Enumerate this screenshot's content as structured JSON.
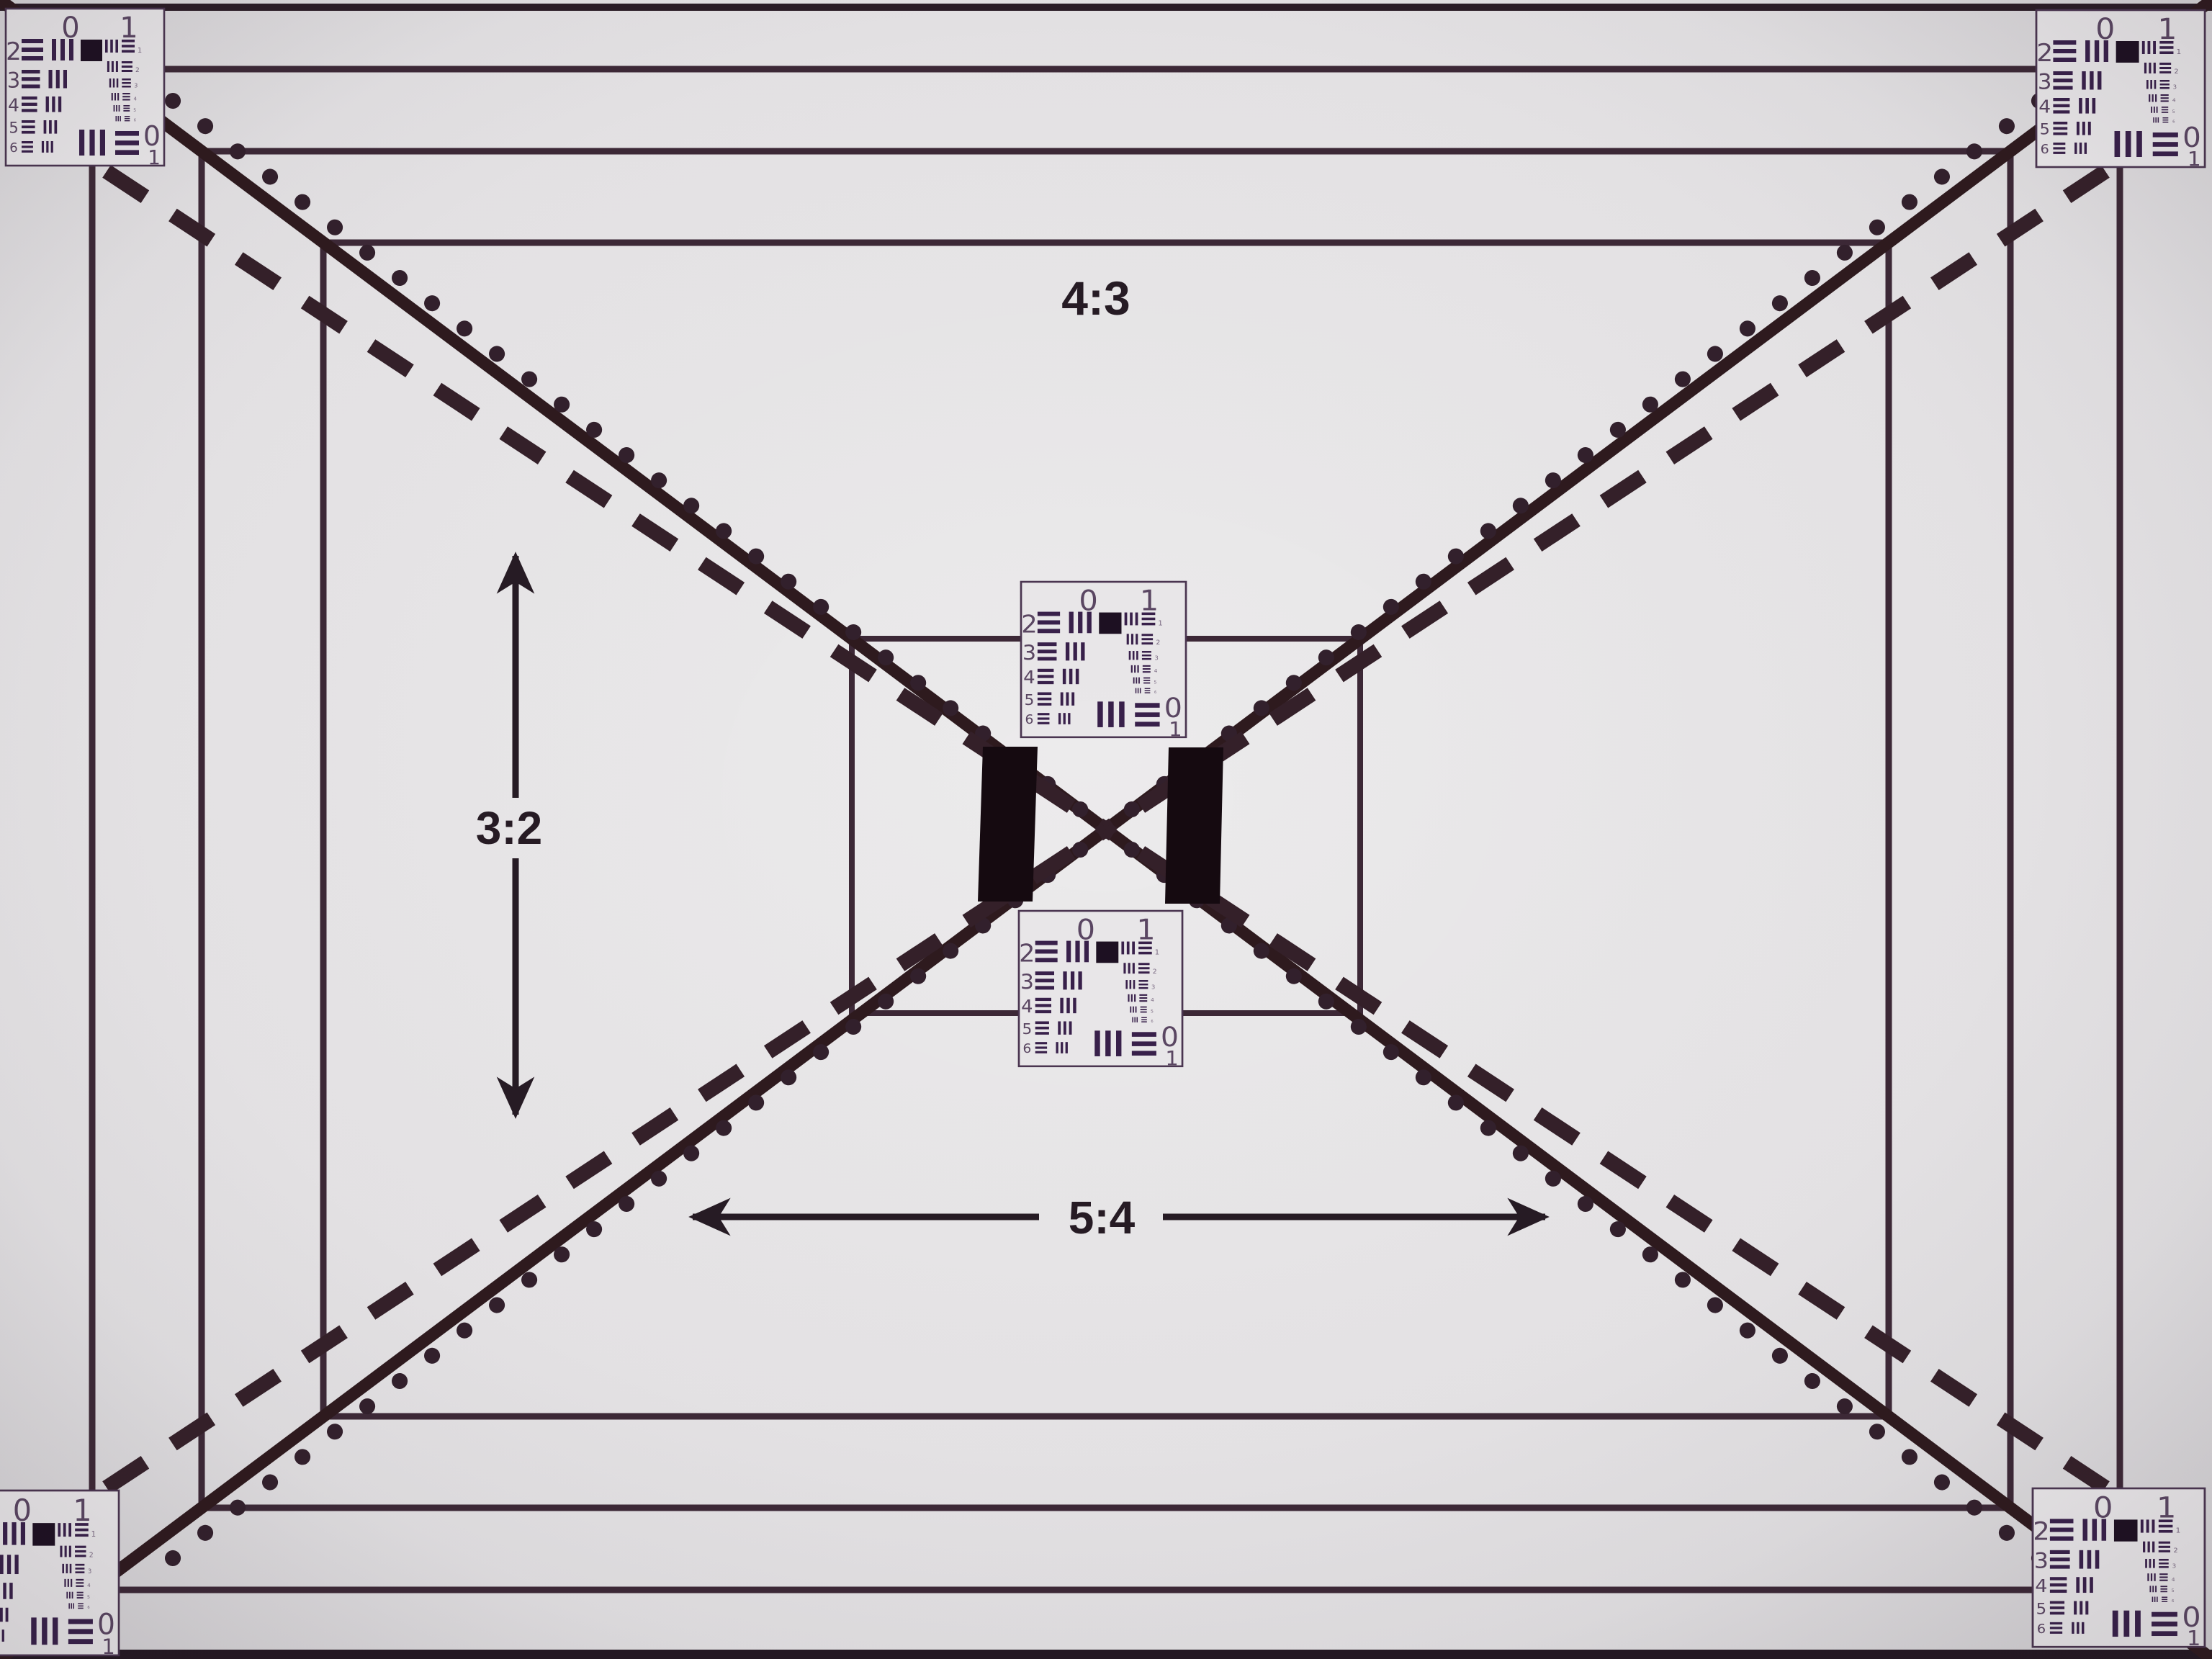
{
  "chart": {
    "description_labels": {
      "aspect_top": "4:3",
      "aspect_left": "3:2",
      "aspect_bottom": "5:4"
    },
    "colors": {
      "background": "#e7e5e7",
      "background_edge": "#d2d0d3",
      "line_solid": "#2e1a1e",
      "line_dotted": "#32202c",
      "line_dashed": "#342029",
      "frame": "#3c2836",
      "label_ink": "#261b24",
      "bar_black": "#150a10",
      "target_bar": "#38204a",
      "target_digit": "#5a4662",
      "target_digit_small": "#7a6a82",
      "target_border": "#4a3550",
      "target_paper": "#e9e7e9",
      "top_border": "#2a1c26",
      "bottom_band": "#231822"
    }
  },
  "resolution_target": {
    "top_labels": [
      "0",
      "1"
    ],
    "row_labels": [
      "2",
      "3",
      "4",
      "5",
      "6"
    ],
    "side_labels": [
      "1",
      "2",
      "3",
      "4",
      "5",
      "6"
    ],
    "bottom_labels": [
      "0",
      "1"
    ]
  },
  "targets": [
    {
      "name": "corner-target-top-left"
    },
    {
      "name": "corner-target-top-right"
    },
    {
      "name": "center-target-upper"
    },
    {
      "name": "center-target-lower"
    },
    {
      "name": "corner-target-bottom-left"
    },
    {
      "name": "corner-target-bottom-right"
    }
  ]
}
